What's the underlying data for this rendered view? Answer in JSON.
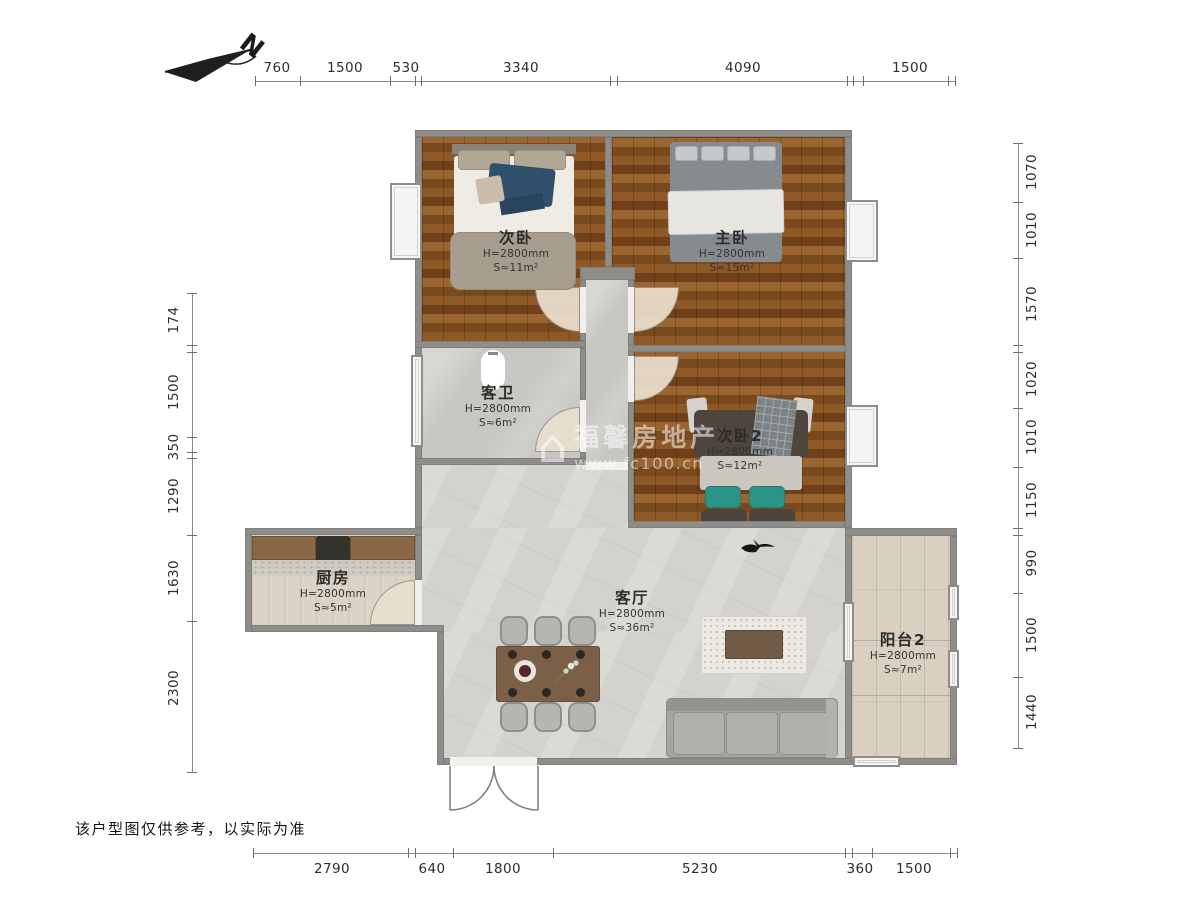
{
  "compass": {
    "label": "N"
  },
  "watermark": {
    "brand": "福馨房地产",
    "url": "www.fc100.cn"
  },
  "disclaimer": "该户型图仅供参考，以实际为准",
  "rooms": [
    {
      "name": "次卧",
      "height": "H=2800mm",
      "area": "S≈11m²"
    },
    {
      "name": "主卧",
      "height": "H=2800mm",
      "area": "S≈15m²"
    },
    {
      "name": "客卫",
      "height": "H=2800mm",
      "area": "S≈6m²"
    },
    {
      "name": "次卧2",
      "height": "H=2800mm",
      "area": "S≈12m²"
    },
    {
      "name": "厨房",
      "height": "H=2800mm",
      "area": "S≈5m²"
    },
    {
      "name": "客厅",
      "height": "H=2800mm",
      "area": "S≈36m²"
    },
    {
      "name": "阳台2",
      "height": "H=2800mm",
      "area": "S≈7m²"
    }
  ],
  "dims": {
    "top": [
      "760",
      "1500",
      "530",
      "3340",
      "4090",
      "1500"
    ],
    "right": [
      "1070",
      "1010",
      "1570",
      "1020",
      "1010",
      "1150",
      "990",
      "1500",
      "1440"
    ],
    "left": [
      "174",
      "1500",
      "350",
      "1290",
      "1630",
      "2300"
    ],
    "bottom": [
      "2790",
      "640",
      "1800",
      "5230",
      "360",
      "1500"
    ]
  }
}
